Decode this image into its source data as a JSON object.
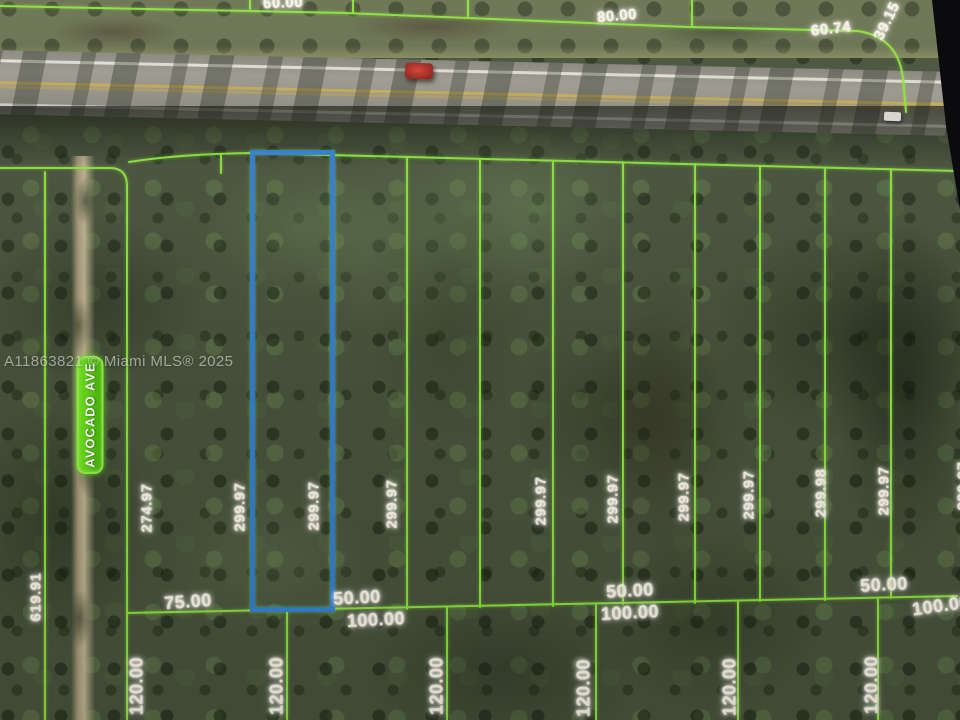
{
  "map": {
    "type": "aerial-parcel-map",
    "watermark": "A11863821 © Miami MLS® 2025",
    "street_label": "AVOCADO AVE",
    "colors": {
      "parcel_line": "#8ce63a",
      "highlighted_parcel": "#2d7ede",
      "street_sign_green": "#5ccf14",
      "label_text": "#faf2e1",
      "center_line_yellow": "#d0b254"
    },
    "dimension_labels": [
      {
        "t": "60.00",
        "x": 283,
        "y": 3,
        "r": -2,
        "s": "md"
      },
      {
        "t": "80.00",
        "x": 617,
        "y": 16,
        "r": -5,
        "s": "md"
      },
      {
        "t": "60.74",
        "x": 831,
        "y": 29,
        "r": -6,
        "s": "md"
      },
      {
        "t": "39.15",
        "x": 887,
        "y": 21,
        "r": -64,
        "s": "md"
      },
      {
        "t": "274.97",
        "x": 147,
        "y": 508,
        "r": -90,
        "s": "md"
      },
      {
        "t": "299.97",
        "x": 240,
        "y": 507,
        "r": -90,
        "s": "md"
      },
      {
        "t": "299.97",
        "x": 314,
        "y": 506,
        "r": -90,
        "s": "md"
      },
      {
        "t": "299.97",
        "x": 392,
        "y": 504,
        "r": -90,
        "s": "md"
      },
      {
        "t": "299.97",
        "x": 541,
        "y": 501,
        "r": -90,
        "s": "md"
      },
      {
        "t": "299.97",
        "x": 613,
        "y": 499,
        "r": -90,
        "s": "md"
      },
      {
        "t": "299.97",
        "x": 684,
        "y": 497,
        "r": -90,
        "s": "md"
      },
      {
        "t": "299.97",
        "x": 749,
        "y": 495,
        "r": -90,
        "s": "md"
      },
      {
        "t": "299.98",
        "x": 821,
        "y": 493,
        "r": -90,
        "s": "md"
      },
      {
        "t": "299.97",
        "x": 884,
        "y": 491,
        "r": -90,
        "s": "md"
      },
      {
        "t": "299.97",
        "x": 963,
        "y": 486,
        "r": -90,
        "s": "md"
      },
      {
        "t": "619.91",
        "x": 36,
        "y": 597,
        "r": -90,
        "s": "md"
      },
      {
        "t": "75.00",
        "x": 188,
        "y": 602,
        "r": -4,
        "s": "lg"
      },
      {
        "t": "50.00",
        "x": 357,
        "y": 598,
        "r": -3,
        "s": "lg"
      },
      {
        "t": "100.00",
        "x": 376,
        "y": 620,
        "r": -3,
        "s": "lg"
      },
      {
        "t": "50.00",
        "x": 630,
        "y": 591,
        "r": -3,
        "s": "lg"
      },
      {
        "t": "100.00",
        "x": 630,
        "y": 613,
        "r": -3,
        "s": "lg"
      },
      {
        "t": "50.00",
        "x": 884,
        "y": 585,
        "r": -3,
        "s": "lg"
      },
      {
        "t": "100.00",
        "x": 941,
        "y": 606,
        "r": -8,
        "s": "lg"
      },
      {
        "t": "120.00",
        "x": 137,
        "y": 686,
        "r": -90,
        "s": "lg"
      },
      {
        "t": "120.00",
        "x": 277,
        "y": 686,
        "r": -90,
        "s": "lg"
      },
      {
        "t": "120.00",
        "x": 437,
        "y": 686,
        "r": -90,
        "s": "lg"
      },
      {
        "t": "120.00",
        "x": 584,
        "y": 688,
        "r": -90,
        "s": "lg"
      },
      {
        "t": "120.00",
        "x": 730,
        "y": 687,
        "r": -90,
        "s": "lg"
      },
      {
        "t": "120.00",
        "x": 872,
        "y": 685,
        "r": -90,
        "s": "lg"
      }
    ]
  }
}
